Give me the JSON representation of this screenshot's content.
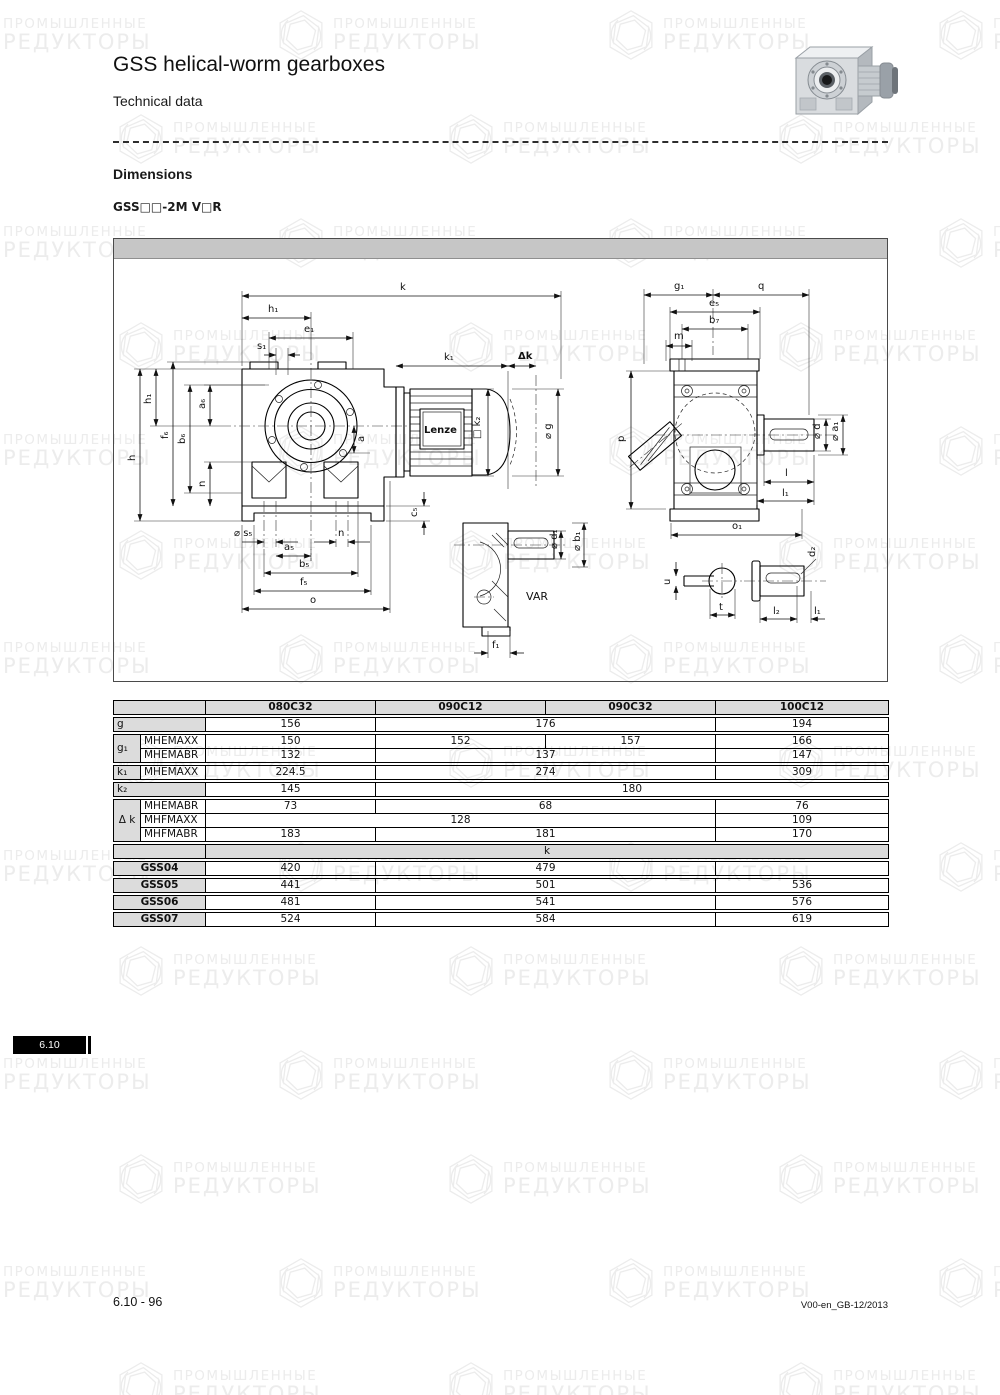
{
  "page": {
    "title": "GSS helical-worm gearboxes",
    "subtitle": "Technical data",
    "section_heading": "Dimensions",
    "model_line": "GSS□□-2M V□R",
    "tab_label": "6.10",
    "footer_left": "6.10 - 96",
    "footer_right": "V00-en_GB-12/2013"
  },
  "watermark": {
    "line1": "ПРОМЫШЛЕННЫЕ",
    "line2": "РЕДУКТОРЫ"
  },
  "colors": {
    "band": "#c6c6c6",
    "label_cell": "#dcdcdc",
    "border": "#000000",
    "tab_bg": "#000000"
  },
  "drawing": {
    "brand": "Lenze",
    "var_label": "VAR",
    "labels": {
      "k": "k",
      "h1": "h₁",
      "e1": "e₁",
      "s1": "s₁",
      "k1": "k₁",
      "dk": "Δk",
      "a6": "a₆",
      "f6": "f₆",
      "b6": "b₆",
      "h": "h",
      "n": "n",
      "a": "a",
      "s5": "⌀ s₅",
      "a5": "a₅",
      "b5": "b₅",
      "f5": "f₅",
      "o": "o",
      "c5": "c₅",
      "k2": "□ k₂",
      "g": "⌀ g",
      "g1": "g₁",
      "q": "q",
      "e5": "e₅",
      "b7": "b₇",
      "m": "m",
      "p": "p",
      "d": "⌀ d",
      "a1": "⌀ a₁",
      "l": "l",
      "l1": "l₁",
      "o1": "o₁",
      "d1": "⌀ d₁",
      "b1": "⌀ b₁",
      "f1": "f₁",
      "u": "u",
      "t": "t",
      "d2": "d₂",
      "l2": "l₂"
    }
  },
  "table": {
    "col_widths": [
      27,
      65,
      170,
      170,
      170,
      173
    ],
    "groups": [
      {
        "rows": [
          [
            {
              "t": "",
              "cls": "lab",
              "cs": 2
            },
            {
              "t": "080C32",
              "cls": "hdr"
            },
            {
              "t": "090C12",
              "cls": "hdr"
            },
            {
              "t": "090C32",
              "cls": "hdr"
            },
            {
              "t": "100C12",
              "cls": "hdr"
            }
          ]
        ]
      },
      {
        "rows": [
          [
            {
              "t": "g",
              "cls": "lab lab-left",
              "cs": 2
            },
            {
              "t": "156"
            },
            {
              "t": "176",
              "cs": 2
            },
            {
              "t": "194"
            }
          ]
        ]
      },
      {
        "rows": [
          [
            {
              "t": "g₁",
              "cls": "lab lab-left",
              "rs": 2
            },
            {
              "t": "MHEMAXX",
              "cls": "sub"
            },
            {
              "t": "150"
            },
            {
              "t": "152"
            },
            {
              "t": "157"
            },
            {
              "t": "166"
            }
          ],
          [
            {
              "t": "MHEMABR",
              "cls": "sub"
            },
            {
              "t": "132"
            },
            {
              "t": "137",
              "cs": 2
            },
            {
              "t": "147"
            }
          ]
        ]
      },
      {
        "rows": [
          [
            {
              "t": "k₁",
              "cls": "lab lab-left"
            },
            {
              "t": "MHEMAXX",
              "cls": "sub"
            },
            {
              "t": "224.5"
            },
            {
              "t": "274",
              "cs": 2
            },
            {
              "t": "309"
            }
          ]
        ]
      },
      {
        "rows": [
          [
            {
              "t": "k₂",
              "cls": "lab lab-left",
              "cs": 2
            },
            {
              "t": "145"
            },
            {
              "t": "180",
              "cs": 3
            }
          ]
        ]
      },
      {
        "rows": [
          [
            {
              "t": "Δ k",
              "cls": "lab lab-center",
              "rs": 3
            },
            {
              "t": "MHEMABR",
              "cls": "sub"
            },
            {
              "t": "73"
            },
            {
              "t": "68",
              "cs": 2
            },
            {
              "t": "76"
            }
          ],
          [
            {
              "t": "MHFMAXX",
              "cls": "sub"
            },
            {
              "t": "128",
              "cs": 3
            },
            {
              "t": "109"
            }
          ],
          [
            {
              "t": "MHFMABR",
              "cls": "sub"
            },
            {
              "t": "183"
            },
            {
              "t": "181",
              "cs": 2
            },
            {
              "t": "170"
            }
          ]
        ]
      },
      {
        "rows": [
          [
            {
              "t": "",
              "cls": "lab",
              "cs": 2
            },
            {
              "t": "k",
              "cls": "hdr2",
              "cs": 4
            }
          ]
        ]
      },
      {
        "rows": [
          [
            {
              "t": "GSS04",
              "cls": "gss",
              "cs": 2
            },
            {
              "t": "420"
            },
            {
              "t": "479",
              "cs": 2
            },
            {
              "t": ""
            }
          ]
        ]
      },
      {
        "rows": [
          [
            {
              "t": "GSS05",
              "cls": "gss",
              "cs": 2
            },
            {
              "t": "441"
            },
            {
              "t": "501",
              "cs": 2
            },
            {
              "t": "536"
            }
          ]
        ]
      },
      {
        "rows": [
          [
            {
              "t": "GSS06",
              "cls": "gss",
              "cs": 2
            },
            {
              "t": "481"
            },
            {
              "t": "541",
              "cs": 2
            },
            {
              "t": "576"
            }
          ]
        ]
      },
      {
        "rows": [
          [
            {
              "t": "GSS07",
              "cls": "gss",
              "cs": 2
            },
            {
              "t": "524"
            },
            {
              "t": "584",
              "cs": 2
            },
            {
              "t": "619"
            }
          ]
        ]
      }
    ]
  }
}
